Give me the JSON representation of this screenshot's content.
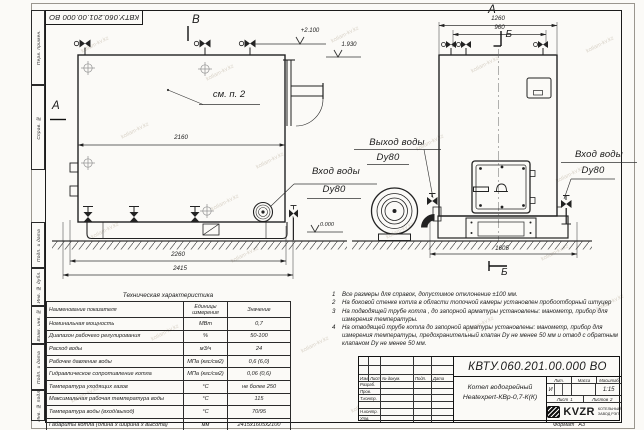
{
  "corner_stamp": "КВТУ.060.201.00.000 ВО",
  "watermark": {
    "text": "kotlam-kv.kz",
    "positions": [
      [
        80,
        42
      ],
      [
        205,
        70
      ],
      [
        330,
        32
      ],
      [
        470,
        62
      ],
      [
        585,
        42
      ],
      [
        120,
        128
      ],
      [
        255,
        158
      ],
      [
        415,
        140
      ],
      [
        555,
        172
      ],
      [
        90,
        228
      ],
      [
        230,
        252
      ],
      [
        385,
        228
      ],
      [
        540,
        250
      ],
      [
        150,
        330
      ],
      [
        300,
        342
      ],
      [
        465,
        322
      ],
      [
        595,
        300
      ],
      [
        70,
        392
      ],
      [
        350,
        402
      ],
      [
        210,
        200
      ]
    ]
  },
  "margin": {
    "perv_primen": "Перв. примен.",
    "sprav_no": "Справ. №",
    "podp_data1": "Подп. и дата",
    "inv_dubl": "Инв. № дубл.",
    "vzam_inv": "Взам. инв. №",
    "podp_data2": "Подп. и дата",
    "inv_podl": "Инв. № подл."
  },
  "drawing": {
    "view_labels": {
      "a_left": "А",
      "b_top": "В",
      "a_top": "А",
      "b_mid": "Б",
      "b_bottom": "Б"
    },
    "annotations": {
      "see_note": "см. п. 2"
    },
    "elevations": {
      "top": "+2.100",
      "flue": "1.930",
      "zero": "0.000"
    },
    "dims": {
      "side_top": "2160",
      "side_mid": "2260",
      "side_bottom": "2415",
      "front_top": "1260",
      "front_inner": "960",
      "front_bottom": "1605"
    },
    "ports": {
      "side_inlet_line1": "Вход воды",
      "side_inlet_line2": "Dy80",
      "front_outlet_line1": "Выход воды",
      "front_outlet_line2": "Dy80",
      "front_inlet_line1": "Вход воды",
      "front_inlet_line2": "Dy80"
    }
  },
  "notes": [
    {
      "num": "1",
      "text": "Все размеры для справок, допустимое отклонение ±100 мм."
    },
    {
      "num": "2",
      "text": "На боковой стенке котла в области топочной камеры установлен пробоотборный штуцер"
    },
    {
      "num": "3",
      "text": "На  подводящей трубе котла , до запорной арматуры установлены:  манометр, прибор для измерения температуры."
    },
    {
      "num": "4",
      "text": "На отводящей трубе котла до запорной арматуры установлены: манометр, прибор для измерения температуры, предохранительный клапан Dу не менее 50 мм и отвод с обратным клапаном Dу не менее 50 мм."
    }
  ],
  "spec_table": {
    "title": "Техническая характеристика",
    "headers": [
      "Наименование показателя",
      "Единицы измерения",
      "Значение"
    ],
    "rows": [
      [
        "Номинальная мощность",
        "МВт",
        "0,7"
      ],
      [
        "Диапазон рабочего регулирования",
        "%",
        "50-100"
      ],
      [
        "Расход воды",
        "м3/ч",
        "24"
      ],
      [
        "Рабочее давление воды",
        "МПа (кгс/см2)",
        "0,6 (6,0)"
      ],
      [
        "Гидравлическое сопротивление котла",
        "МПа (кгс/см2)",
        "0,06 (0,6)"
      ],
      [
        "Температура уходящих газов",
        "°С",
        "не более 250"
      ],
      [
        "Максимальная рабочая температура воды",
        "°С",
        "115"
      ],
      [
        "Температура воды (вход/выход)",
        "°С",
        "70/95"
      ],
      [
        "Габариты котла (длина х ширина х высота)",
        "мм",
        "2415х1605х2100"
      ]
    ]
  },
  "title_block": {
    "doc_number": "КВТУ.060.201.00.000 ВО",
    "product_name_1": "Котел водогрейный",
    "product_name_2": "Heatexpert-КВр-0,7-К(К)",
    "header_cells": [
      "Изм.",
      "Лист",
      "№ докум.",
      "Подп.",
      "Дата"
    ],
    "rows": [
      "Разраб.",
      "Пров.",
      "Т.контр.",
      "",
      "Н.контр.",
      "Утв."
    ],
    "lit_label": "Лит.",
    "lit_value": "И",
    "mass_label": "Масса",
    "scale_label": "Масштаб",
    "scale_value": "1:15",
    "sheet_label": "Лист",
    "sheet_value": "1",
    "sheets_label": "Листов",
    "sheets_value": "2",
    "company": "KVZR",
    "company_sub_1": "КОТЕЛЬНЫЙ",
    "company_sub_2": "ЗАВОД РЭП",
    "format_label": "Формат",
    "format_value": "А3"
  }
}
